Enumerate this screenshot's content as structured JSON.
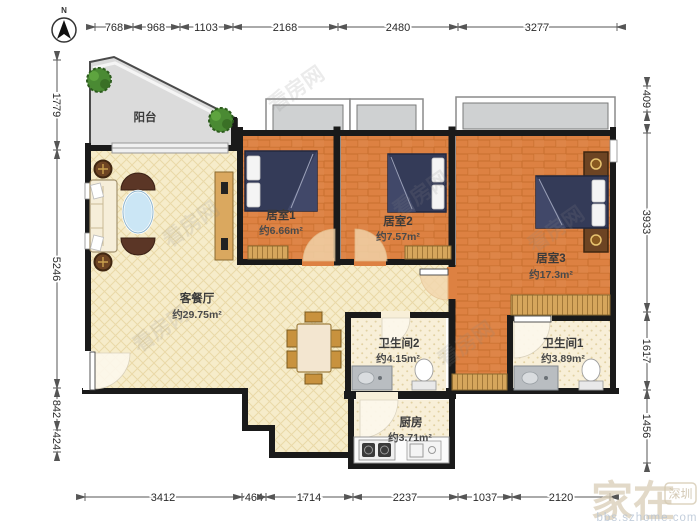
{
  "compass": {
    "label": "N"
  },
  "dimensions": {
    "top": [
      "768",
      "968",
      "1103",
      "2168",
      "2480",
      "3277"
    ],
    "left": [
      "1779",
      "5246",
      "842",
      "424"
    ],
    "right": [
      "409",
      "3933",
      "1617",
      "1456"
    ],
    "bottom": [
      "3412",
      "464",
      "1714",
      "2237",
      "1037",
      "2120"
    ]
  },
  "rooms": {
    "balcony": {
      "name": "阳台"
    },
    "bedroom1": {
      "name": "居室1",
      "area": "约6.66m²"
    },
    "bedroom2": {
      "name": "居室2",
      "area": "约7.57m²"
    },
    "bedroom3": {
      "name": "居室3",
      "area": "约17.3m²"
    },
    "living_dining": {
      "name": "客餐厅",
      "area": "约29.75m²"
    },
    "bathroom2": {
      "name": "卫生间2",
      "area": "约4.15m²"
    },
    "bathroom1": {
      "name": "卫生间1",
      "area": "约3.89m²"
    },
    "kitchen": {
      "name": "厨房",
      "area": "约3.71m²"
    }
  },
  "watermarks": {
    "site": "看房网",
    "brand": "家在",
    "brand_badge": "深圳",
    "brand_url": "bbs.szhome.com"
  },
  "colors": {
    "wall": "#1a1a1a",
    "wood_floor": "#dd8142",
    "tile_floor": "#f6ecca",
    "balcony_floor": "#dbdbdb",
    "bed": "#343b58",
    "furniture_wood": "#d2a15a"
  }
}
